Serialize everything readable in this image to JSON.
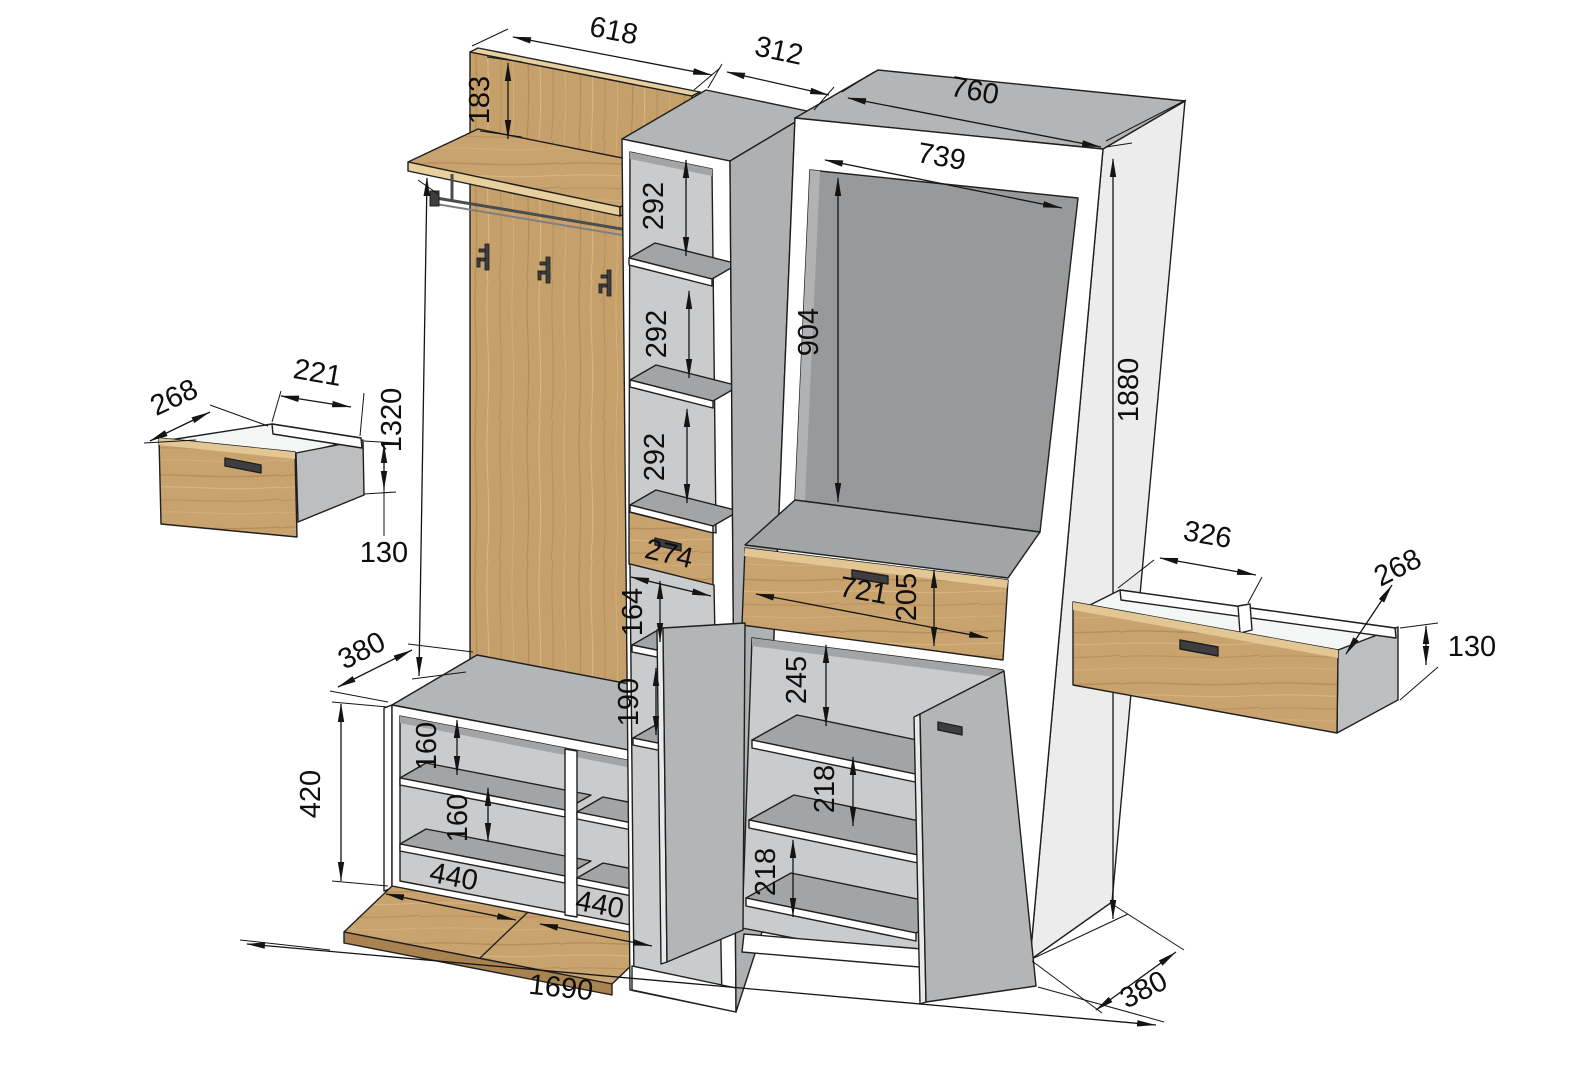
{
  "drawing": {
    "type": "furniture-technical-drawing",
    "subject": "hallway wardrobe set with coat panel, shelf column, cabinet, bench and drawers",
    "units": "mm",
    "colors": {
      "wood": "#c9a36e",
      "carcass_gray": "#b3b5b7",
      "interior_gray": "#97999b",
      "line": "#1a1a1a",
      "background": "#ffffff"
    },
    "dims": {
      "total_width": "1690",
      "depth": "380",
      "total_height": "1880",
      "panel_width": "618",
      "panel_top_offset": "183",
      "panel_height": "1320",
      "column_width": "312",
      "cabinet_width": "760",
      "cabinet_inner_width": "739",
      "cabinet_opening_height": "904",
      "shelf_spacing": "292",
      "column_drawer_width": "274",
      "cabinet_drawer_width": "721",
      "cabinet_drawer_height": "205",
      "column_gap_upper": "164",
      "column_gap_lower": "190",
      "cabinet_gap_top": "245",
      "cabinet_shelf_spacing": "218",
      "bench_height": "420",
      "bench_shelf_spacing": "160",
      "flap_width": "440",
      "small_drawer_inner_width": "221",
      "drawer_depth": "268",
      "drawer_height": "130",
      "wide_drawer_inner_width": "326"
    }
  }
}
